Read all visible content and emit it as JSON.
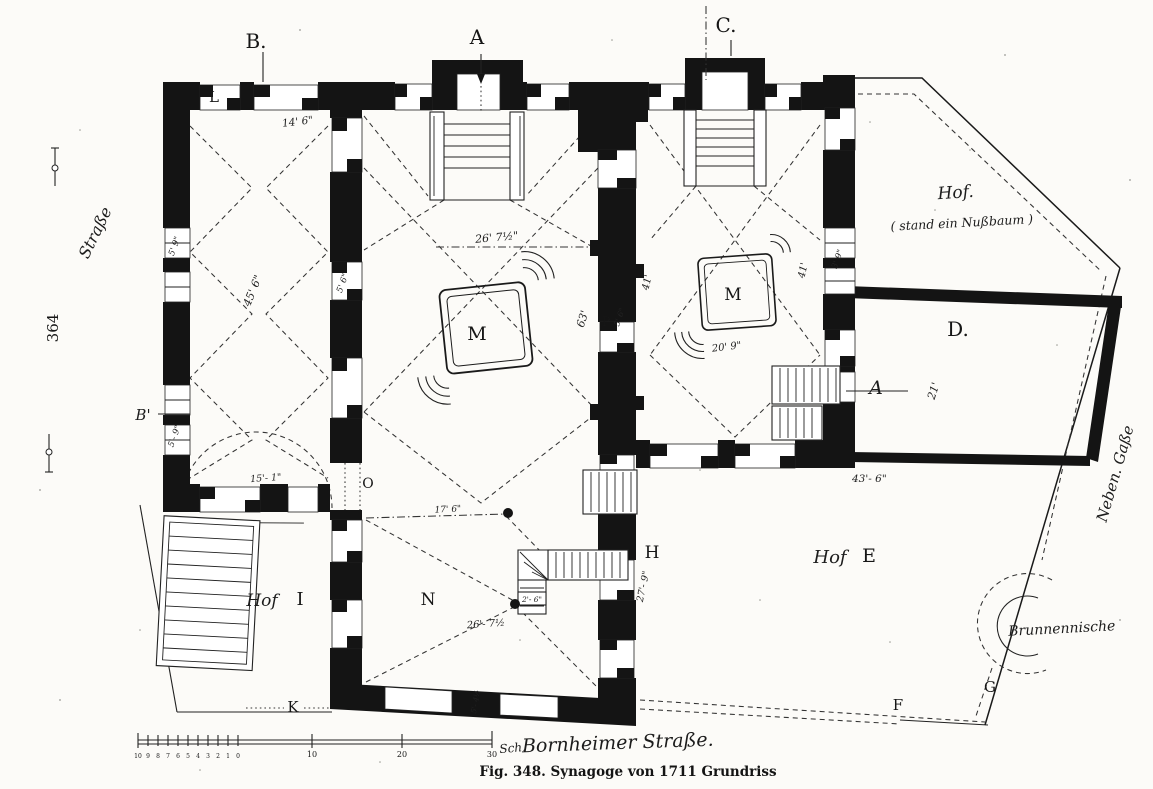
{
  "figure": {
    "caption": "Fig. 348.  Synagoge von 1711   Grundriss",
    "page_number": "364"
  },
  "streets": {
    "left": "Straße",
    "bottom": "Bornheimer Straße.",
    "right": "Neben. Gaße"
  },
  "courtyards": {
    "hof_top_title": "Hof.",
    "hof_top_note": "( stand ein Nußbaum )",
    "hof_e_prefix": "Hof",
    "hof_e_letter": "E",
    "hof_i_prefix": "Hof",
    "hof_i_letter": "I",
    "well_niche": "Brunnennische"
  },
  "section_markers": {
    "b": "B.",
    "a": "A",
    "c": "C."
  },
  "letters": {
    "l": "L",
    "b_prime": "B'",
    "m_main": "M",
    "m_right": "M",
    "o": "O",
    "n": "N",
    "h": "H",
    "k": "K",
    "d": "D.",
    "f": "F",
    "g": "G",
    "p": "P",
    "door_a": "A"
  },
  "dimensions": {
    "top_left_bay": "14' 6\"",
    "left_hall_length": "45' 6\"",
    "left_wall_window_upper": "5' 9\"",
    "left_wall_window_lower": "5'- 9\"",
    "inner_wall_window": "5' 6\"",
    "left_hall_width": "15'- 1\"",
    "main_hall_width": "26' 7½\"",
    "main_hall_length": "63'",
    "p_opening": "5' 6\"",
    "right_hall_length_w": "41'",
    "right_hall_length_e": "41'",
    "right_wall_window": "3' 9\"",
    "right_hall_width": "20' 9\"",
    "room_d_width": "21'",
    "hof_e_top": "43'- 6\"",
    "n_room_top": "17' 6\"",
    "n_room_width": "26'- 7½",
    "n_stair": "2'- 6\"",
    "h_wall": "27'- 9\"",
    "bottom_wall_window": "5'- 4½"
  },
  "scale": {
    "fine_ticks": [
      "10",
      "9",
      "8",
      "7",
      "6",
      "5",
      "4",
      "3",
      "2",
      "1",
      "0"
    ],
    "major_ticks": [
      "10",
      "20",
      "30"
    ],
    "unit": "Sch."
  }
}
